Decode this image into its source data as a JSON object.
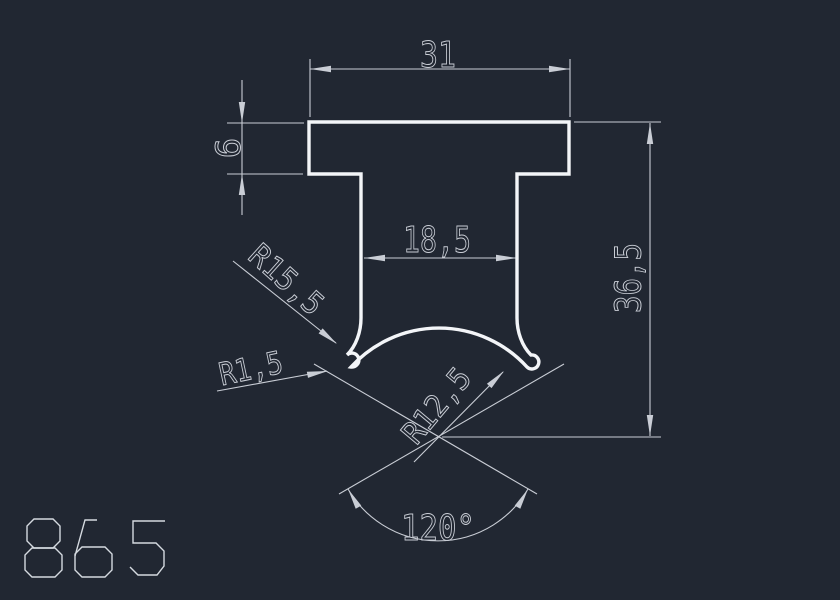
{
  "drawing": {
    "part_number": "865",
    "dim_top_width": "31",
    "dim_flange_thickness": "6",
    "dim_slot_width": "18,5",
    "dim_total_height": "36,5",
    "dim_radius_outer": "R15,5",
    "dim_radius_fillet": "R1,5",
    "dim_radius_inner": "R12,5",
    "dim_angle": "120°",
    "colors": {
      "background": "#212732",
      "profile": "#f3f5f8",
      "dimension": "#c9cdd5",
      "part_number_color": "#d5dae0"
    }
  }
}
